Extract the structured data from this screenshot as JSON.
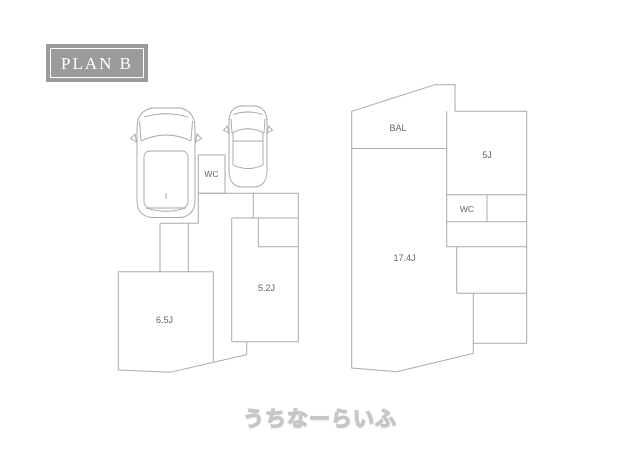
{
  "plan_badge": {
    "label": "PLAN B"
  },
  "watermark": {
    "text": "うちなーらいふ"
  },
  "colors": {
    "line": "#aaaaaa",
    "badge_background": "#9b9b9b",
    "badge_border": "#ffffff",
    "badge_text": "#ffffff",
    "room_label_text": "#666666",
    "watermark_fill": "#ffffff",
    "watermark_outline": "#c6c6c6"
  },
  "floorplan": {
    "left_building": {
      "labels": {
        "wc": "WC",
        "room_52": "5.2J",
        "room_65": "6.5J"
      }
    },
    "right_building": {
      "labels": {
        "balcony": "BAL",
        "room_5": "5J",
        "wc": "WC",
        "room_174": "17.4J"
      }
    }
  }
}
